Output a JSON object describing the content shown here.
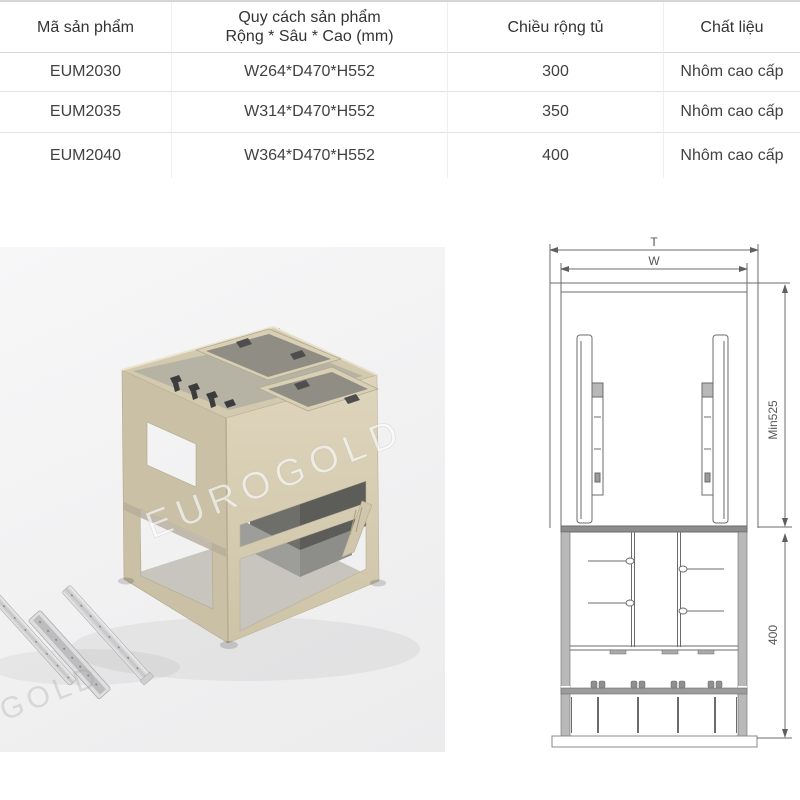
{
  "table": {
    "header": {
      "product_code": "Mã sản phẩm",
      "spec_line1": "Quy cách sản phẩm",
      "spec_line2": "Rộng * Sâu * Cao (mm)",
      "cabinet_width": "Chiều rộng tủ",
      "material": "Chất liệu"
    },
    "rows": [
      {
        "code": "EUM2030",
        "size": "W264*D470*H552",
        "width": "300",
        "material": "Nhôm cao cấp"
      },
      {
        "code": "EUM2035",
        "size": "W314*D470*H552",
        "width": "350",
        "material": "Nhôm cao cấp"
      },
      {
        "code": "EUM2040",
        "size": "W364*D470*H552",
        "width": "400",
        "material": "Nhôm cao cấp"
      }
    ]
  },
  "photo": {
    "watermark_text": "EUROGOLD"
  },
  "diagram": {
    "dim_total_width": "T",
    "dim_basket_width": "W",
    "dim_min_depth": "Min525",
    "dim_basket_height": "400"
  },
  "colors": {
    "frame_champagne": "#d2c9ae",
    "divider_gray": "#4e4e4e",
    "diagram_line": "#5f5f5f",
    "table_border": "#e2e2e2",
    "photo_background": "#f1f1f2"
  }
}
